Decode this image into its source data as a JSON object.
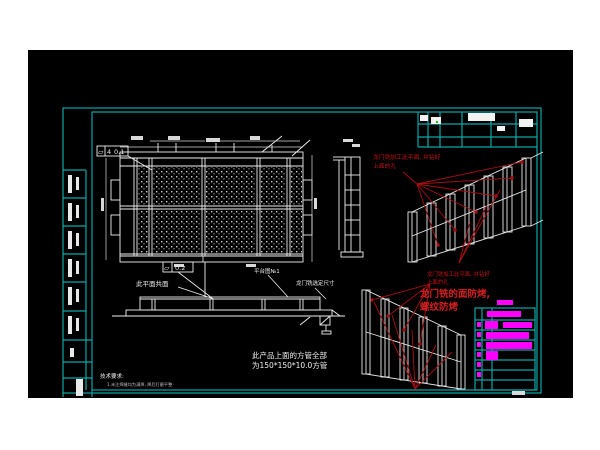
{
  "colors": {
    "canvas_bg": "#000000",
    "frame_cyan": "#0ca6a6",
    "line_white": "#f0f0f0",
    "annotation_red": "#c41414",
    "highlight_magenta": "#ff00ff"
  },
  "notes_white": {
    "coplanar": "此平面共面",
    "platform": "平台图№1",
    "gantry_dim": "龙门铣选定尺寸",
    "tube_line1": "此产品上面的方管全部",
    "tube_line2": "为150*150*10.0方管",
    "tech_title": "技术要求:",
    "tech_line": "1.未注焊缝均为满焊, 焊后打磨平整"
  },
  "notes_red": {
    "top_line1": "龙门铣加工此平面, 并钻好",
    "top_line2": "上面的孔",
    "mid_line1": "龙门铣加工此平面, 并钻好",
    "mid_line2": "上面的孔",
    "big_line1": "龙门铣的面防烤,",
    "big_line2": "螺纹防烤"
  },
  "tolerances": {
    "top": {
      "symbol": "▱",
      "count": "4",
      "value": "0.1"
    },
    "mid": {
      "symbol": "▱",
      "value": "0.2"
    }
  }
}
